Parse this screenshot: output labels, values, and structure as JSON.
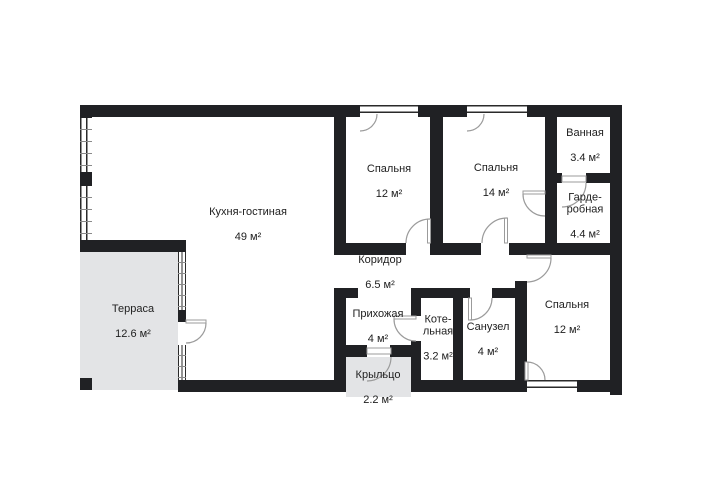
{
  "title": "План дома",
  "colors": {
    "wall": "#202124",
    "outdoor_area_fill": "#e3e4e6",
    "door_arc": "#9b9b9b",
    "background": "#ffffff",
    "text": "#212121"
  },
  "rooms": [
    {
      "id": "kitchen-living",
      "name": "Кухня-гостиная",
      "area": "49 м²"
    },
    {
      "id": "bedroom-top-left",
      "name": "Спальня",
      "area": "12 м²"
    },
    {
      "id": "bedroom-top-mid",
      "name": "Спальня",
      "area": "14 м²"
    },
    {
      "id": "bathroom",
      "name": "Ванная",
      "area": "3.4 м²"
    },
    {
      "id": "wardrobe",
      "name": "Гарде-\nробная",
      "area": "4.4 м²"
    },
    {
      "id": "corridor",
      "name": "Коридор",
      "area": "6.5 м²"
    },
    {
      "id": "hallway",
      "name": "Прихожая",
      "area": "4 м²"
    },
    {
      "id": "boiler-room",
      "name": "Коте-\nльная",
      "area": "3.2 м²"
    },
    {
      "id": "wc",
      "name": "Санузел",
      "area": "4 м²"
    },
    {
      "id": "bedroom-right",
      "name": "Спальня",
      "area": "12 м²"
    },
    {
      "id": "terrace",
      "name": "Терраса",
      "area": "12.6 м²"
    },
    {
      "id": "porch",
      "name": "Крыльцо",
      "area": "2.2 м²"
    }
  ]
}
